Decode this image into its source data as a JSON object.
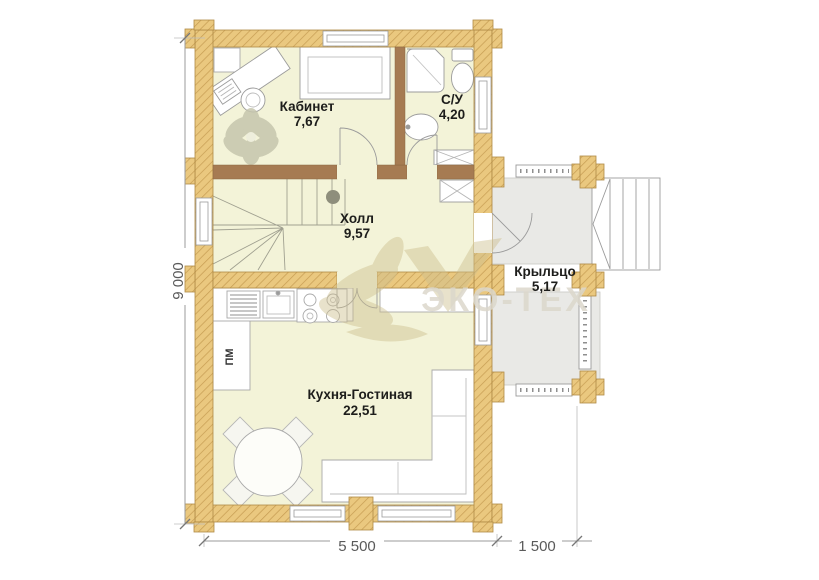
{
  "plan": {
    "rooms": {
      "kabinet": {
        "name": "Кабинет",
        "area": "7,67"
      },
      "su": {
        "name": "С/У",
        "area": "4,20"
      },
      "holl": {
        "name": "Холл",
        "area": "9,57"
      },
      "kryltso": {
        "name": "Крыльцо",
        "area": "5,17"
      },
      "kitchen": {
        "name": "Кухня-Гостиная",
        "area": "22,51"
      }
    },
    "dimensions": {
      "height_total": "9 000",
      "width_main": "5 500",
      "width_porch": "1 500"
    },
    "annotations": {
      "dishwasher": "ПМ"
    },
    "watermark": {
      "text": "ЭКО-ТЕХ"
    },
    "colors": {
      "wall_log": "#eac87f",
      "wall_hatch": "#c69c52",
      "wall_edge": "#b08a45",
      "wall_interior": "#a67b52",
      "room_fill": "#f3f3d8",
      "porch_fill": "#e9e9e6",
      "furniture_stroke": "#999999",
      "stair_stroke": "#a0a090",
      "label_color": "#1d1d1b",
      "dimension_color": "#5a5a5a",
      "watermark_text": "#dcd8cc",
      "watermark_flower": "#cdbf8e",
      "newel_post": "#8e8e7c"
    }
  }
}
